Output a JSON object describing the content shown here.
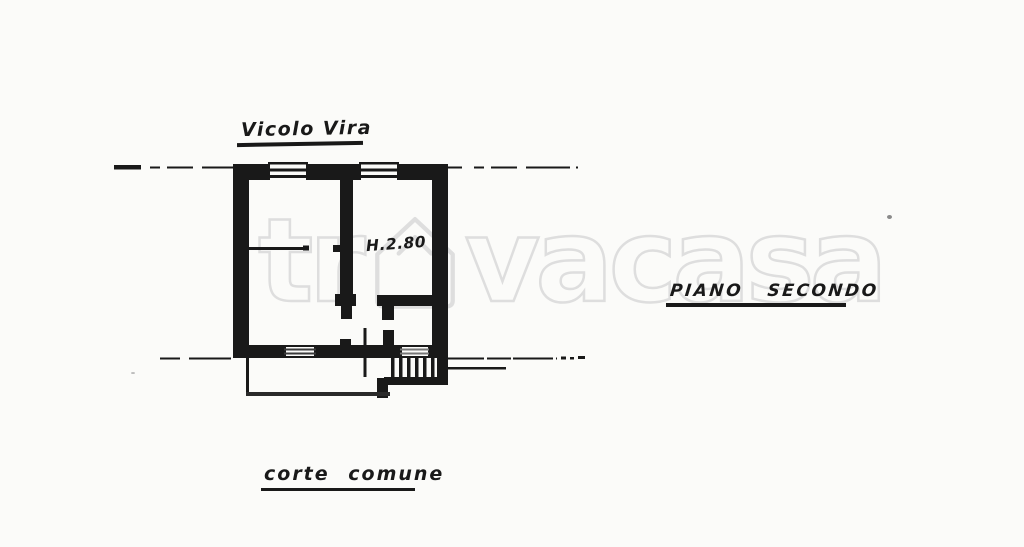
{
  "page": {
    "background": "#fbfbf9",
    "ink_color": "#191919",
    "faded_ink_color": "#777777",
    "watermark_color": "#dedede"
  },
  "labels": {
    "street": "Vicolo Vira",
    "floor": "PIANO SECONDO",
    "courtyard": "corte comune",
    "ceiling_height": "H.2.80"
  },
  "watermark": {
    "prefix": "tr",
    "suffix": "vacasa"
  }
}
